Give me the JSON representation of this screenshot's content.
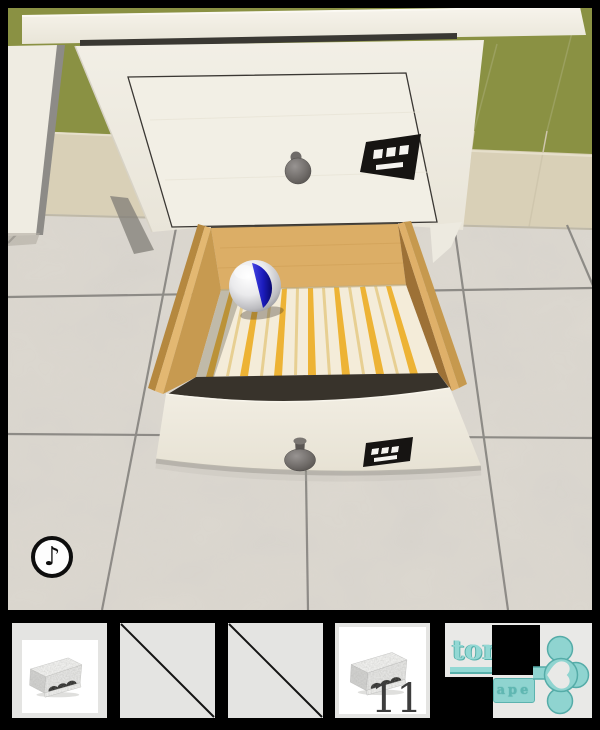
{
  "hud": {
    "sound_button_glyph": "♪"
  },
  "colors": {
    "wall_olive": "#8a9143",
    "wall_beige": "#d9d0b7",
    "cabinet_white": "#f1eee4",
    "drawer_wood": "#dcae66",
    "lining_stripe_yellow": "#edb12d",
    "ball_blue": "#1b1bbc",
    "floor_marble": "#d8d4cd",
    "logo_teal": "#8fd4d0"
  },
  "scene": {
    "stickers": [
      {
        "location": "closed-drawer",
        "white_squares": 3,
        "white_bars": 1
      },
      {
        "location": "open-drawer-front",
        "white_squares": 3,
        "white_bars": 1
      }
    ],
    "objects": {
      "ball": "white ball with blue band",
      "open_drawer": "open drawer with yellow striped lining",
      "closed_drawer": "closed drawer with gray knob"
    }
  },
  "inventory": {
    "slots": [
      {
        "index": 1,
        "state": "filled",
        "item": "stone-block",
        "count": ""
      },
      {
        "index": 2,
        "state": "empty"
      },
      {
        "index": 3,
        "state": "empty"
      },
      {
        "index": 4,
        "state": "filled",
        "item": "stone-block",
        "count": "11"
      },
      {
        "index": 5,
        "state": "logo"
      }
    ]
  },
  "logo": {
    "text_top": "tom",
    "text_plate": "ape"
  }
}
